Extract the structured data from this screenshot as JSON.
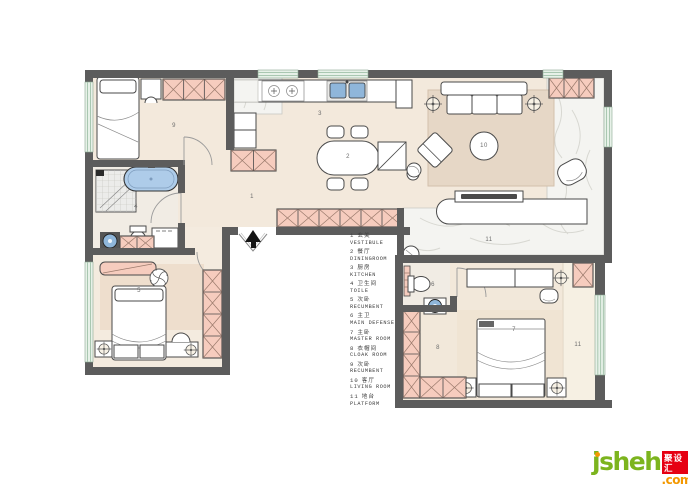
{
  "rooms": [
    {
      "num": "1",
      "zh": "玄关",
      "en": "VESTIBULE"
    },
    {
      "num": "2",
      "zh": "餐厅",
      "en": "DININGROOM"
    },
    {
      "num": "3",
      "zh": "厨房",
      "en": "KITCHEN"
    },
    {
      "num": "4",
      "zh": "卫生间",
      "en": "TOILE"
    },
    {
      "num": "5",
      "zh": "次卧",
      "en": "RECUMBENT"
    },
    {
      "num": "6",
      "zh": "主卫",
      "en": "MAIN DEFENSE"
    },
    {
      "num": "7",
      "zh": "主卧",
      "en": "MASTER ROOM"
    },
    {
      "num": "8",
      "zh": "衣帽间",
      "en": "CLOAK ROOM"
    },
    {
      "num": "9",
      "zh": "次卧",
      "en": "RECUMBENT"
    },
    {
      "num": "10",
      "zh": "客厅",
      "en": "LIVING ROOM"
    },
    {
      "num": "11",
      "zh": "地台",
      "en": "PLATFORM"
    }
  ],
  "logo": {
    "name": "jsheh",
    "badge": "聚设汇",
    "suffix": ".com"
  },
  "colors": {
    "wall": "#5c5c5c",
    "floor": "#f3e9dc",
    "cabinet_pink": "#f6ccbe",
    "window_green": "#e7f1e8",
    "bathtub_blue": "#aecce9",
    "sink_blue": "#8fb6da",
    "logo_green": "#7cb41e",
    "logo_orange": "#f39800",
    "badge_red": "#e60012"
  }
}
